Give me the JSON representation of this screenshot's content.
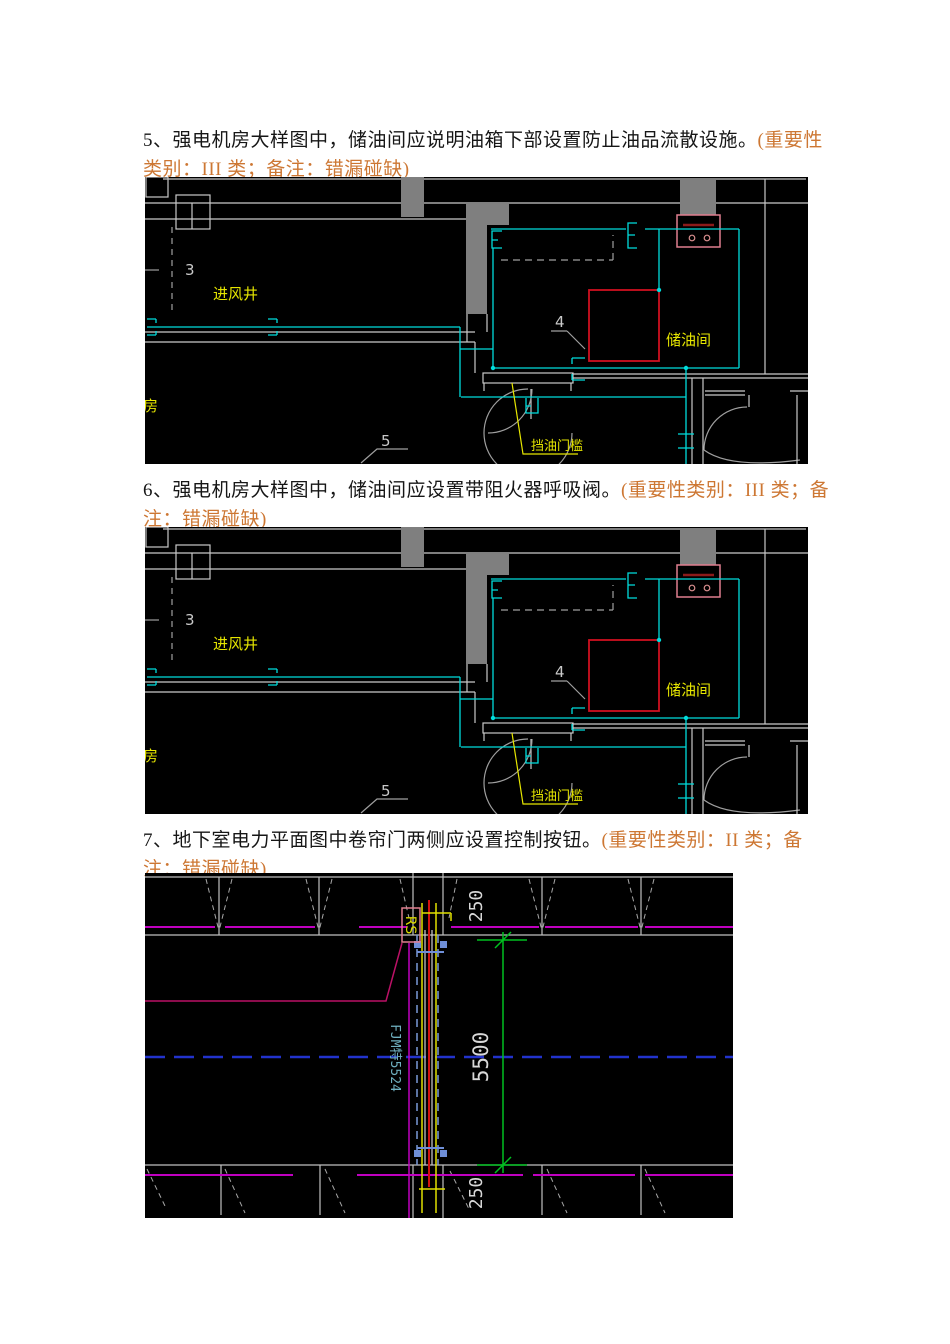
{
  "page": {
    "width": 950,
    "height": 1344,
    "background": "#ffffff"
  },
  "items": [
    {
      "text": "5、强电机房大样图中，储油间应说明油箱下部设置防止油品流散设施。",
      "note": "(重要性类别：III 类；备注：错漏碰缺)"
    },
    {
      "text": "6、强电机房大样图中，储油间应设置带阻火器呼吸阀。",
      "note": "(重要性类别：III 类；备注：错漏碰缺)"
    },
    {
      "text": "7、地下室电力平面图中卷帘门两侧应设置控制按钮。",
      "note": "(重要性类别：II 类；备注：错漏碰缺)"
    }
  ],
  "cad_detail": {
    "axis_no": "3",
    "air_shaft_label": "进风井",
    "machine_room_label": "机房",
    "tank_tag": "4",
    "oil_room_label": "储油间",
    "detail_tag": "5",
    "threshold_label": "挡油门槛"
  },
  "cad_plan": {
    "shutter_tag": "RS",
    "door_code": "FJM特5524",
    "dim_top": "250",
    "dim_height": "5500",
    "dim_bottom": "250"
  },
  "colors": {
    "note_orange": "#cd7733",
    "cad_cyan": "#00dcdc",
    "cad_yellow": "#e6e600",
    "cad_red": "#d01010",
    "cad_magenta": "#c000c0",
    "cad_green": "#00c020",
    "centerline_blue": "#2233cc",
    "box_pink": "#e07f8f"
  }
}
